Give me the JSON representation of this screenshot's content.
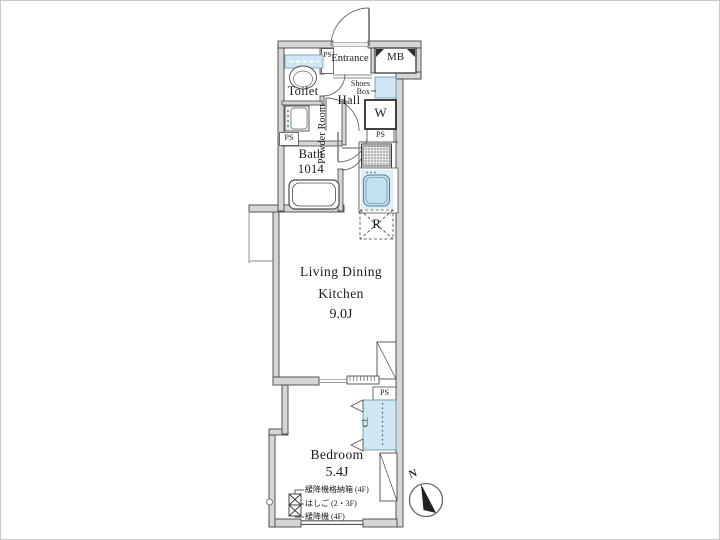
{
  "plan": {
    "compass": {
      "label": "N"
    },
    "rooms": {
      "entrance": {
        "label": "Entrance"
      },
      "meter_box": {
        "label": "MB"
      },
      "pipe_space_entrance": {
        "label": "PS"
      },
      "toilet": {
        "label": "Toilet"
      },
      "hall": {
        "label": "Hall"
      },
      "shoes_box": {
        "line1": "Shoes",
        "line2": "Box"
      },
      "washing_machine": {
        "label": "W"
      },
      "pipe_space_kitchen": {
        "label": "PS"
      },
      "powder_room": {
        "label": "Powder Room"
      },
      "pipe_space_powder": {
        "label": "PS"
      },
      "bath": {
        "label": "Bath",
        "size": "1014"
      },
      "refrigerator": {
        "label": "R"
      },
      "living_dining_kitchen": {
        "line1": "Living Dining",
        "line2": "Kitchen",
        "size": "9.0J"
      },
      "pipe_space_bedroom": {
        "label": "PS"
      },
      "closet": {
        "label": "Cl."
      },
      "bedroom": {
        "label": "Bedroom",
        "size": "5.4J"
      }
    },
    "annotations": {
      "descender_box": "緩降機格納箱 (4F)",
      "ladder": "はしご (2・3F)",
      "descender": "緩降機 (4F)"
    },
    "colors": {
      "wall_fill": "#d6d6d6",
      "wall_stroke": "#454545",
      "fixture_fill": "#cfe7f2",
      "fixture_stroke": "#6b9cb5",
      "background": "#ffffff",
      "text": "#1b1b1b"
    }
  }
}
